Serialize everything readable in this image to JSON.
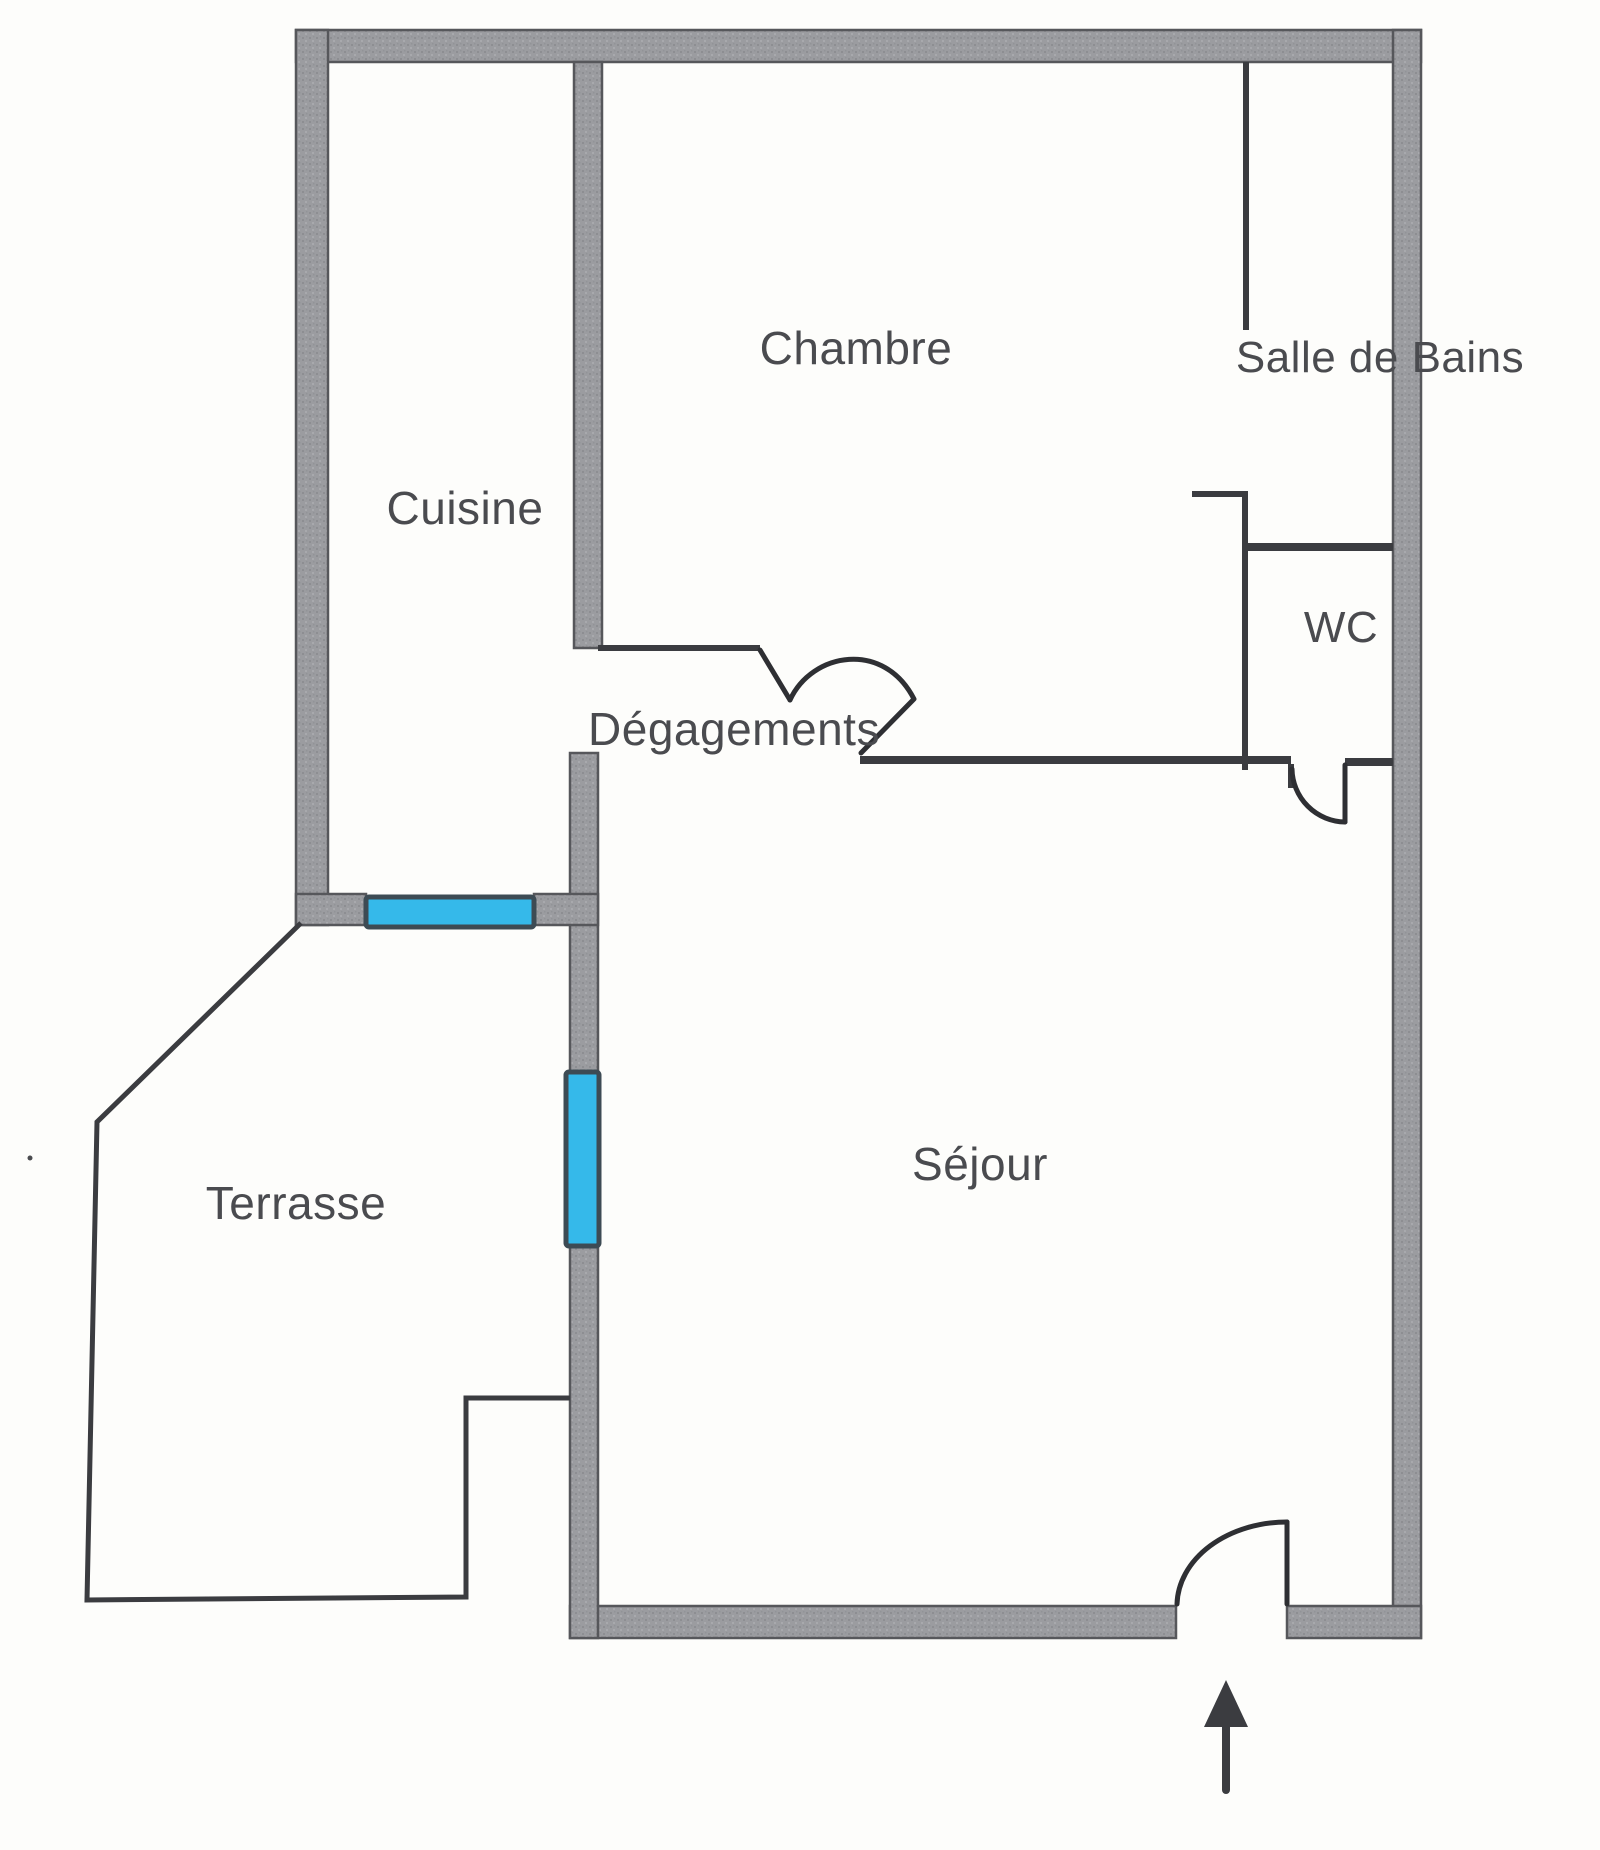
{
  "document": {
    "type": "floor-plan",
    "language": "fr",
    "style": "scanned apartment plan, gray outer walls, thin black interior walls, cyan windows"
  },
  "rooms": {
    "chambre": {
      "label": "Chambre"
    },
    "salle_de_bains": {
      "label": "Salle de Bains"
    },
    "wc": {
      "label": "WC"
    },
    "cuisine": {
      "label": "Cuisine"
    },
    "degagements": {
      "label": "Dégagements"
    },
    "sejour": {
      "label": "Séjour"
    },
    "terrasse": {
      "label": "Terrasse"
    }
  },
  "icons": {
    "entrance_arrow": "arrow-up-entrance-marker"
  },
  "colors": {
    "bg": "#fdfdfb",
    "wall-fill": "#9b9ca0",
    "wall-edge": "#56575b",
    "thin-wall": "#3b3c40",
    "door-line": "#2e2f33",
    "window-fill": "#35b9ea",
    "window-edge": "#3d4b54",
    "label": "#4a4b4f"
  }
}
